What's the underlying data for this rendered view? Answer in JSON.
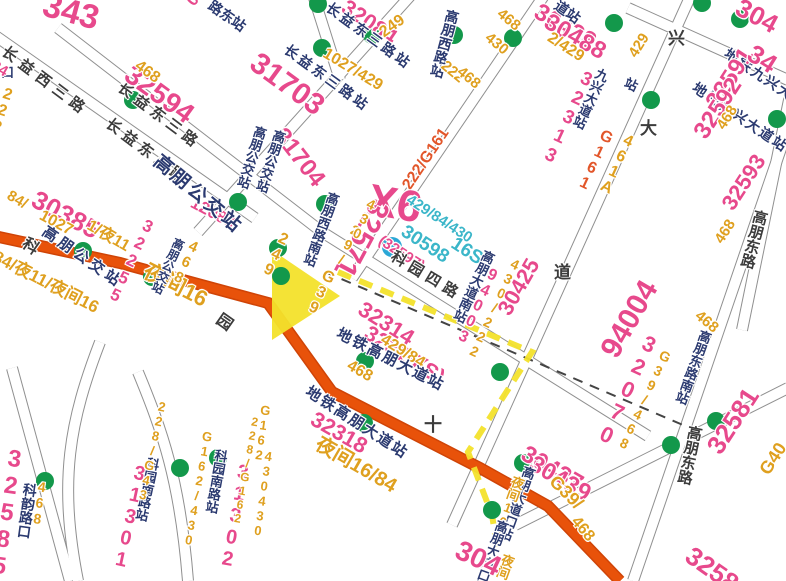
{
  "map": {
    "title": "bus-transit-map",
    "colors": {
      "pink": "#e7498c",
      "orange": "#dfa01f",
      "red": "#e2562a",
      "cyan": "#3bb6c9",
      "navy": "#2b3a70",
      "street": "#3c3c3c",
      "road": "#e8520a",
      "road_casing": "#cf4407",
      "street_casing": "#8f8f8f",
      "yellow": "#f3e22b",
      "green_stop": "#13984b",
      "metro_blue": "#2ba7d6",
      "metro_dash": "#444444"
    },
    "streets": [
      "M -20,25 L 255,218",
      "M 58,28 L 322,232 L 648,436",
      "M 198,232 L 420,-15",
      "M 352,278 L 558,-25",
      "M 452,525 L 700,-25",
      "M 633,581 L 788,128",
      "M 515,525 L 788,388",
      "M 628,8 L 788,80",
      "M 742,330 L 790,95",
      "M 138,372 C 162,430 180,480 188,581",
      "M 100,342 C 70,420 58,480 78,581",
      "M 12,368 L 70,581",
      "M 310,-15 L 340,80"
    ],
    "main_road": "M -6,236 L 120,263 L 268,303 L 332,392 L 480,468 L 548,506 L 620,581",
    "metro_line": "M 325,272 L 690,428",
    "route_highlight": "M 338,272 L 532,352 L 468,452 L 492,515 L 498,552",
    "route_arrow": "272,250 340,296 272,340",
    "bus_stops": [
      [
        133,
        100
      ],
      [
        318,
        4
      ],
      [
        322,
        48
      ],
      [
        372,
        35
      ],
      [
        454,
        35
      ],
      [
        513,
        38
      ],
      [
        614,
        23
      ],
      [
        651,
        100
      ],
      [
        702,
        3
      ],
      [
        740,
        19
      ],
      [
        777,
        119
      ],
      [
        238,
        202
      ],
      [
        83,
        251
      ],
      [
        152,
        277
      ],
      [
        278,
        248
      ],
      [
        281,
        276
      ],
      [
        325,
        204
      ],
      [
        365,
        361
      ],
      [
        500,
        372
      ],
      [
        364,
        423
      ],
      [
        492,
        510
      ],
      [
        523,
        463
      ],
      [
        671,
        445
      ],
      [
        716,
        421
      ],
      [
        180,
        468
      ],
      [
        218,
        458
      ],
      [
        45,
        481
      ]
    ],
    "metro_station": [
      392,
      247
    ],
    "labels": [
      {
        "t": "343",
        "x": 48,
        "y": -12,
        "r": 15,
        "c": "pink",
        "s": 34
      },
      {
        "t": "086",
        "x": 183,
        "y": -2,
        "r": -50,
        "c": "pink",
        "s": 17
      },
      {
        "t": "路东站",
        "x": 214,
        "y": -2,
        "r": 35,
        "c": "navy",
        "s": 14
      },
      {
        "t": "长益西三路",
        "x": 8,
        "y": 44,
        "r": 37,
        "c": "street",
        "s": 15,
        "sp": 6
      },
      {
        "t": "长益东三路",
        "x": 124,
        "y": 80,
        "r": 37,
        "c": "street",
        "s": 15,
        "sp": 5
      },
      {
        "t": "长益东三路",
        "x": 112,
        "y": 116,
        "r": 37,
        "c": "street",
        "s": 15,
        "sp": 5
      },
      {
        "t": "32594",
        "x": 136,
        "y": 60,
        "r": 36,
        "c": "pink",
        "s": 28
      },
      {
        "t": "468",
        "x": 141,
        "y": 58,
        "r": 36,
        "c": "orange",
        "s": 16
      },
      {
        "t": "口",
        "x": 1,
        "y": 66,
        "r": 0,
        "c": "navy",
        "s": 13
      },
      {
        "t": "222",
        "x": 2,
        "y": 84,
        "r": 18,
        "c": "orange",
        "s": 16,
        "v": 1
      },
      {
        "t": "84",
        "x": -4,
        "y": 58,
        "r": 30,
        "c": "pink",
        "s": 15
      },
      {
        "t": "32084",
        "x": 350,
        "y": -4,
        "r": 34,
        "c": "pink",
        "s": 22
      },
      {
        "t": "长益东三路站",
        "x": 332,
        "y": 0,
        "r": 36,
        "c": "navy",
        "s": 14,
        "sp": 3
      },
      {
        "t": "长益东三路站",
        "x": 290,
        "y": 42,
        "r": 36,
        "c": "navy",
        "s": 14,
        "sp": 3
      },
      {
        "t": "31703",
        "x": 262,
        "y": 48,
        "r": 36,
        "c": "pink",
        "s": 30
      },
      {
        "t": "249",
        "x": 377,
        "y": 28,
        "r": -36,
        "c": "orange",
        "s": 16
      },
      {
        "t": "1027/429",
        "x": 328,
        "y": 46,
        "r": 31,
        "c": "orange",
        "s": 16
      },
      {
        "t": "31704",
        "x": 288,
        "y": 124,
        "r": 52,
        "c": "pink",
        "s": 24
      },
      {
        "t": "高朋西路站",
        "x": 447,
        "y": 8,
        "r": 15,
        "c": "navy",
        "s": 14,
        "v": 1
      },
      {
        "t": "468",
        "x": 504,
        "y": 6,
        "r": 40,
        "c": "orange",
        "s": 15
      },
      {
        "t": "430",
        "x": 492,
        "y": 30,
        "r": 40,
        "c": "orange",
        "s": 15
      },
      {
        "t": "222",
        "x": 448,
        "y": 58,
        "r": 40,
        "c": "orange",
        "s": 15
      },
      {
        "t": "468",
        "x": 464,
        "y": 64,
        "r": 40,
        "c": "orange",
        "s": 15
      },
      {
        "t": "222/G161",
        "x": 400,
        "y": 184,
        "r": -56,
        "c": "red",
        "s": 16
      },
      {
        "t": "30438",
        "x": 542,
        "y": 0,
        "r": 30,
        "c": "pink",
        "s": 24
      },
      {
        "t": "30488",
        "x": 552,
        "y": 10,
        "r": 30,
        "c": "pink",
        "s": 24
      },
      {
        "t": "道站",
        "x": 560,
        "y": -2,
        "r": 35,
        "c": "navy",
        "s": 14
      },
      {
        "t": "2/429",
        "x": 553,
        "y": 30,
        "r": 33,
        "c": "orange",
        "s": 16
      },
      {
        "t": "兴",
        "x": 668,
        "y": 30,
        "r": 0,
        "c": "street",
        "s": 17
      },
      {
        "t": "大",
        "x": 640,
        "y": 120,
        "r": 0,
        "c": "street",
        "s": 17
      },
      {
        "t": "道",
        "x": 554,
        "y": 264,
        "r": 0,
        "c": "street",
        "s": 17
      },
      {
        "t": "32313",
        "x": 582,
        "y": 66,
        "r": 25,
        "c": "pink",
        "s": 19,
        "v": 1
      },
      {
        "t": "九兴大道站",
        "x": 598,
        "y": 66,
        "r": 25,
        "c": "navy",
        "s": 13,
        "v": 1
      },
      {
        "t": "G161",
        "x": 602,
        "y": 126,
        "r": 25,
        "c": "red",
        "s": 16,
        "v": 1
      },
      {
        "t": "461A",
        "x": 624,
        "y": 130,
        "r": 25,
        "c": "orange",
        "s": 16,
        "v": 1
      },
      {
        "t": "429",
        "x": 626,
        "y": 52,
        "r": -58,
        "c": "orange",
        "s": 15
      },
      {
        "t": "站",
        "x": 628,
        "y": 76,
        "r": 25,
        "c": "navy",
        "s": 13
      },
      {
        "t": "地铁九兴大道站",
        "x": 730,
        "y": 46,
        "r": 34,
        "c": "navy",
        "s": 14,
        "sp": 2
      },
      {
        "t": "地铁九兴大道站",
        "x": 698,
        "y": 80,
        "r": 34,
        "c": "navy",
        "s": 14,
        "sp": 2
      },
      {
        "t": "32591",
        "x": 702,
        "y": 100,
        "r": -57,
        "c": "pink",
        "s": 24
      },
      {
        "t": "32592",
        "x": 690,
        "y": 130,
        "r": -57,
        "c": "pink",
        "s": 24
      },
      {
        "t": "468",
        "x": 714,
        "y": 124,
        "r": -57,
        "c": "orange",
        "s": 15
      },
      {
        "t": "304",
        "x": 744,
        "y": -6,
        "r": 28,
        "c": "pink",
        "s": 26
      },
      {
        "t": "34",
        "x": 757,
        "y": 40,
        "r": 32,
        "c": "pink",
        "s": 26
      },
      {
        "t": "84/",
        "x": 12,
        "y": 188,
        "r": 30,
        "c": "orange",
        "s": 15
      },
      {
        "t": "30385",
        "x": 40,
        "y": 186,
        "r": 28,
        "c": "pink",
        "s": 26
      },
      {
        "t": "1027",
        "x": 44,
        "y": 208,
        "r": 28,
        "c": "orange",
        "s": 16
      },
      {
        "t": "1/夜11",
        "x": 92,
        "y": 218,
        "r": 30,
        "c": "orange",
        "s": 16
      },
      {
        "t": "高朋公交站",
        "x": 48,
        "y": 224,
        "r": 35,
        "c": "navy",
        "s": 15,
        "sp": 4
      },
      {
        "t": "科",
        "x": 28,
        "y": 236,
        "r": 35,
        "c": "street",
        "s": 16
      },
      {
        "t": "园",
        "x": 222,
        "y": 312,
        "r": 35,
        "c": "street",
        "s": 16
      },
      {
        "t": "84/夜11/夜间16",
        "x": -2,
        "y": 248,
        "r": 27,
        "c": "orange",
        "s": 17
      },
      {
        "t": "夜间16",
        "x": 150,
        "y": 260,
        "r": 27,
        "c": "orange",
        "s": 22
      },
      {
        "t": "32255",
        "x": 144,
        "y": 214,
        "r": 25,
        "c": "pink",
        "s": 17,
        "v": 1
      },
      {
        "t": "12088",
        "x": 196,
        "y": 194,
        "r": 28,
        "c": "pink",
        "s": 17
      },
      {
        "t": "468",
        "x": 190,
        "y": 236,
        "r": 25,
        "c": "orange",
        "s": 15,
        "v": 1
      },
      {
        "t": "高朋公交站",
        "x": 175,
        "y": 236,
        "r": 25,
        "c": "navy",
        "s": 12,
        "v": 1
      },
      {
        "t": "高朋公交站",
        "x": 162,
        "y": 152,
        "r": 40,
        "c": "navy",
        "s": 19,
        "sp": 3
      },
      {
        "t": "高朋公交站",
        "x": 255,
        "y": 124,
        "r": 18,
        "c": "navy",
        "s": 13,
        "v": 1
      },
      {
        "t": "高朋公交站",
        "x": 274,
        "y": 128,
        "r": 18,
        "c": "navy",
        "s": 13,
        "v": 1
      },
      {
        "t": "X6",
        "x": 372,
        "y": 178,
        "r": 10,
        "c": "pink",
        "s": 44
      },
      {
        "t": "429/84/430",
        "x": 412,
        "y": 192,
        "r": 33,
        "c": "cyan",
        "s": 15
      },
      {
        "t": "30598",
        "x": 408,
        "y": 222,
        "r": 33,
        "c": "cyan",
        "s": 19
      },
      {
        "t": "16S",
        "x": 458,
        "y": 234,
        "r": 33,
        "c": "cyan",
        "s": 19
      },
      {
        "t": "(32597)",
        "x": 384,
        "y": 233,
        "r": 33,
        "c": "pink",
        "s": 15
      },
      {
        "t": "科园四路",
        "x": 396,
        "y": 249,
        "r": 31,
        "c": "street",
        "s": 15,
        "sp": 5
      },
      {
        "t": "32571",
        "x": 394,
        "y": 208,
        "r": 118,
        "c": "pink",
        "s": 30
      },
      {
        "t": "高朋西路南站",
        "x": 328,
        "y": 190,
        "r": 20,
        "c": "navy",
        "s": 13,
        "v": 1
      },
      {
        "t": "G39",
        "x": 324,
        "y": 266,
        "r": 25,
        "c": "orange",
        "s": 16,
        "v": 1
      },
      {
        "t": "249",
        "x": 279,
        "y": 228,
        "r": 25,
        "c": "orange",
        "s": 16,
        "v": 1
      },
      {
        "t": "29/",
        "x": 352,
        "y": 220,
        "r": 25,
        "c": "orange",
        "s": 14,
        "v": 1
      },
      {
        "t": "430",
        "x": 368,
        "y": 194,
        "r": 25,
        "c": "orange",
        "s": 14,
        "v": 1
      },
      {
        "t": "32314",
        "x": 366,
        "y": 298,
        "r": 32,
        "c": "pink",
        "s": 22
      },
      {
        "t": "32315(S)",
        "x": 372,
        "y": 322,
        "r": 32,
        "c": "pink",
        "s": 22
      },
      {
        "t": "429/84",
        "x": 386,
        "y": 332,
        "r": 32,
        "c": "orange",
        "s": 16
      },
      {
        "t": "地铁高朋大道站",
        "x": 341,
        "y": 326,
        "r": 27,
        "c": "navy",
        "s": 15,
        "sp": 2
      },
      {
        "t": "地铁高朋大道站",
        "x": 311,
        "y": 384,
        "r": 33,
        "c": "navy",
        "s": 15,
        "sp": 2
      },
      {
        "t": "32318",
        "x": 318,
        "y": 408,
        "r": 30,
        "c": "pink",
        "s": 22
      },
      {
        "t": "夜间16/84",
        "x": 322,
        "y": 434,
        "r": 30,
        "c": "orange",
        "s": 20
      },
      {
        "t": "468",
        "x": 352,
        "y": 358,
        "r": 30,
        "c": "orange",
        "s": 16
      },
      {
        "t": "十",
        "x": 424,
        "y": 416,
        "r": 0,
        "c": "street",
        "s": 18
      },
      {
        "t": "高朋大道南站",
        "x": 484,
        "y": 248,
        "r": 25,
        "c": "navy",
        "s": 13,
        "v": 1
      },
      {
        "t": "430/222",
        "x": 512,
        "y": 254,
        "r": 25,
        "c": "orange",
        "s": 14,
        "v": 1
      },
      {
        "t": "30425",
        "x": 494,
        "y": 308,
        "r": -60,
        "c": "pink",
        "s": 22
      },
      {
        "t": "94003",
        "x": 488,
        "y": 264,
        "r": 25,
        "c": "pink",
        "s": 16,
        "v": 1
      },
      {
        "t": "94004",
        "x": 596,
        "y": 348,
        "r": -60,
        "c": "pink",
        "s": 30
      },
      {
        "t": "32070",
        "x": 644,
        "y": 328,
        "r": 25,
        "c": "pink",
        "s": 22,
        "v": 1
      },
      {
        "t": "G39/468",
        "x": 662,
        "y": 346,
        "r": 25,
        "c": "orange",
        "s": 14,
        "v": 1
      },
      {
        "t": "高朋东路南站",
        "x": 700,
        "y": 328,
        "r": 20,
        "c": "navy",
        "s": 13,
        "v": 1
      },
      {
        "t": "468",
        "x": 702,
        "y": 308,
        "r": 40,
        "c": "orange",
        "s": 15
      },
      {
        "t": "32593",
        "x": 718,
        "y": 202,
        "r": -57,
        "c": "pink",
        "s": 22
      },
      {
        "t": "468",
        "x": 712,
        "y": 238,
        "r": -57,
        "c": "orange",
        "s": 15
      },
      {
        "t": "高朋东路",
        "x": 754,
        "y": 208,
        "r": 15,
        "c": "street",
        "s": 15,
        "v": 1
      },
      {
        "t": "高朋东路",
        "x": 688,
        "y": 424,
        "r": 12,
        "c": "street",
        "s": 15,
        "v": 1
      },
      {
        "t": "32581",
        "x": 702,
        "y": 444,
        "r": -57,
        "c": "pink",
        "s": 26
      },
      {
        "t": "G40",
        "x": 756,
        "y": 468,
        "r": -57,
        "c": "orange",
        "s": 18
      },
      {
        "t": "32582",
        "x": 696,
        "y": 542,
        "r": 35,
        "c": "pink",
        "s": 26
      },
      {
        "t": "30437",
        "x": 529,
        "y": 442,
        "r": 30,
        "c": "pink",
        "s": 24
      },
      {
        "t": "30439",
        "x": 537,
        "y": 452,
        "r": 30,
        "c": "pink",
        "s": 24
      },
      {
        "t": "G39/",
        "x": 559,
        "y": 472,
        "r": 45,
        "c": "orange",
        "s": 18
      },
      {
        "t": "高朋大道口站",
        "x": 524,
        "y": 464,
        "r": 20,
        "c": "navy",
        "s": 13,
        "v": 1
      },
      {
        "t": "夜间16/",
        "x": 513,
        "y": 474,
        "r": 20,
        "c": "orange",
        "s": 13,
        "v": 1
      },
      {
        "t": "468",
        "x": 580,
        "y": 514,
        "r": 50,
        "c": "orange",
        "s": 16
      },
      {
        "t": "高朋大道口站",
        "x": 497,
        "y": 518,
        "r": 20,
        "c": "navy",
        "s": 13,
        "v": 1
      },
      {
        "t": "夜间16",
        "x": 503,
        "y": 552,
        "r": 20,
        "c": "orange",
        "s": 13,
        "v": 1
      },
      {
        "t": "304",
        "x": 463,
        "y": 536,
        "r": 25,
        "c": "pink",
        "s": 28
      },
      {
        "t": "32585",
        "x": 4,
        "y": 444,
        "r": 8,
        "c": "pink",
        "s": 24,
        "v": 1
      },
      {
        "t": "科韵路口",
        "x": 24,
        "y": 482,
        "r": 8,
        "c": "navy",
        "s": 14,
        "v": 1
      },
      {
        "t": "468",
        "x": 36,
        "y": 478,
        "r": 8,
        "c": "orange",
        "s": 14,
        "v": 1
      },
      {
        "t": "31301",
        "x": 132,
        "y": 461,
        "r": 12,
        "c": "pink",
        "s": 20,
        "v": 1
      },
      {
        "t": "科园南路站",
        "x": 147,
        "y": 456,
        "r": 12,
        "c": "navy",
        "s": 13,
        "v": 1
      },
      {
        "t": "228/G43",
        "x": 157,
        "y": 398,
        "r": 12,
        "c": "orange",
        "s": 13,
        "v": 1
      },
      {
        "t": "G162/430",
        "x": 202,
        "y": 428,
        "r": 10,
        "c": "orange",
        "s": 13,
        "v": 1
      },
      {
        "t": "科园南路站",
        "x": 215,
        "y": 448,
        "r": 10,
        "c": "navy",
        "s": 13,
        "v": 1
      },
      {
        "t": "31302",
        "x": 235,
        "y": 460,
        "r": 10,
        "c": "pink",
        "s": 20,
        "v": 1
      },
      {
        "t": "228/G162",
        "x": 250,
        "y": 414,
        "r": 10,
        "c": "orange",
        "s": 12,
        "v": 1
      },
      {
        "t": "G162",
        "x": 260,
        "y": 402,
        "r": 8,
        "c": "orange",
        "s": 13,
        "v": 1
      },
      {
        "t": "430430",
        "x": 263,
        "y": 448,
        "r": 8,
        "c": "orange",
        "s": 13,
        "v": 1
      }
    ]
  }
}
